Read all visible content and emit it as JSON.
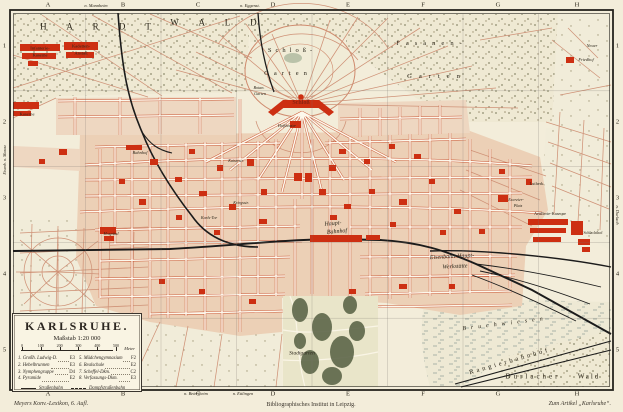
{
  "title": "Karlsruhe — Stadtplan (Meyers Konversations-Lexikon)",
  "frame": {
    "grid_cols": [
      "A",
      "B",
      "C",
      "D",
      "E",
      "F",
      "G",
      "H"
    ],
    "grid_rows": [
      "1",
      "2",
      "3",
      "4",
      "5"
    ]
  },
  "captions": {
    "publisher_left": "Meyers Konv.-Lexikon, 6. Aufl.",
    "publisher_center": "Bibliographisches Institut in Leipzig.",
    "article_right": "Zum Artikel „Karlsruhe“."
  },
  "legend_box": {
    "title": "KARLSRUHE.",
    "scale": "Maßstab 1:20 000",
    "scale_ticks": [
      "0",
      "100",
      "200",
      "300",
      "400",
      "500"
    ],
    "scale_unit": "Meter",
    "items": [
      {
        "label": "1. Großh. Ludwig-D.",
        "ref": "E3"
      },
      {
        "label": "2. Hebelbrunnen",
        "ref": "E3"
      },
      {
        "label": "3. Nymphengruppe",
        "ref": "D4"
      },
      {
        "label": "4. Pyramide",
        "ref": "E2"
      },
      {
        "label": "5. Mädchengymnasium",
        "ref": "F2"
      },
      {
        "label": "6. Realschule",
        "ref": "E2"
      },
      {
        "label": "7. Scheffel-Dkm.",
        "ref": "C2"
      },
      {
        "label": "8. Verfassungs-Dkm.",
        "ref": "E3"
      }
    ],
    "line_keys": [
      {
        "style": "solid",
        "label": "Straßenbahn"
      },
      {
        "style": "dashdot",
        "label": "Dampfstraßenbahn"
      }
    ]
  },
  "colors": {
    "paper": "#f3edda",
    "city_block": "#ecd0b6",
    "landmark_red": "#cd2f12",
    "street_edge": "#c8502e",
    "railway": "#1b1b1b",
    "forest_dot": "#8e8c6e",
    "park_green": "#5d6649"
  },
  "map_labels": [
    {
      "t": "H A R D T",
      "x": 100,
      "y": 27,
      "s": 9,
      "ls": 9
    },
    {
      "t": "W A L D",
      "x": 218,
      "y": 23,
      "s": 9,
      "ls": 9
    },
    {
      "t": "Schloß-",
      "x": 292,
      "y": 51,
      "s": 6.5,
      "ls": 4
    },
    {
      "t": "Garten",
      "x": 288,
      "y": 74,
      "s": 6.5,
      "ls": 5
    },
    {
      "t": "Fasanen-",
      "x": 432,
      "y": 44,
      "s": 6.5,
      "ls": 6
    },
    {
      "t": "Garten",
      "x": 437,
      "y": 77,
      "s": 6.5,
      "ls": 7
    },
    {
      "t": "Schloß",
      "x": 301,
      "y": 103,
      "s": 6,
      "b": 1,
      "c": "#8c2312"
    },
    {
      "t": "Botan.",
      "x": 259,
      "y": 88,
      "s": 4.2,
      "i": 1
    },
    {
      "t": "Garten",
      "x": 260,
      "y": 94,
      "s": 4.2,
      "i": 1
    },
    {
      "t": "Hoftheater",
      "x": 287,
      "y": 126,
      "s": 4.2,
      "i": 1
    },
    {
      "t": "Infanterie-",
      "x": 40,
      "y": 49,
      "s": 4.6
    },
    {
      "t": "Kaserne",
      "x": 40,
      "y": 56,
      "s": 4.6
    },
    {
      "t": "Kadetten-",
      "x": 81,
      "y": 47,
      "s": 4.6
    },
    {
      "t": "Anstalt",
      "x": 81,
      "y": 54,
      "s": 4.6
    },
    {
      "t": "Kaserne",
      "x": 27,
      "y": 115,
      "s": 4.6
    },
    {
      "t": "Bahnhof",
      "x": 140,
      "y": 153,
      "s": 4.4,
      "i": 1
    },
    {
      "t": "Karls-Tor",
      "x": 209,
      "y": 218,
      "s": 4.2,
      "i": 1
    },
    {
      "t": "Hospital",
      "x": 111,
      "y": 234,
      "s": 4.4,
      "i": 1
    },
    {
      "t": "Kaiserstr.",
      "x": 236,
      "y": 161,
      "s": 4,
      "i": 1
    },
    {
      "t": "Kriegsstr.",
      "x": 241,
      "y": 203,
      "s": 4,
      "i": 1
    },
    {
      "t": "Haupt-",
      "x": 333,
      "y": 224,
      "s": 6,
      "i": 1,
      "r": -5
    },
    {
      "t": "Bahnhof",
      "x": 337,
      "y": 232,
      "s": 6,
      "i": 1,
      "r": -5
    },
    {
      "t": "Stadtgarten",
      "x": 302,
      "y": 354,
      "s": 5.5,
      "i": 1
    },
    {
      "t": "Eisenbahn-Haupt-",
      "x": 452,
      "y": 257,
      "s": 6,
      "i": 1,
      "r": -3
    },
    {
      "t": "Werkstätte",
      "x": 455,
      "y": 267,
      "s": 6,
      "i": 1,
      "r": -3
    },
    {
      "t": "Bruchwiesen",
      "x": 505,
      "y": 324,
      "s": 6,
      "ls": 5,
      "r": -7,
      "i": 1
    },
    {
      "t": "Rangierbahnhof",
      "x": 510,
      "y": 362,
      "s": 6.5,
      "ls": 3,
      "r": -16
    },
    {
      "t": "Durlacher",
      "x": 533,
      "y": 377,
      "s": 7,
      "ls": 3
    },
    {
      "t": "Wald",
      "x": 589,
      "y": 377,
      "s": 7,
      "ls": 2
    },
    {
      "t": "Neuer",
      "x": 592,
      "y": 46,
      "s": 4.4,
      "i": 1
    },
    {
      "t": "Friedhof",
      "x": 586,
      "y": 60,
      "s": 4.4,
      "i": 1
    },
    {
      "t": "Lutherk.",
      "x": 537,
      "y": 184,
      "s": 4.4
    },
    {
      "t": "Artillerie-Kaserne",
      "x": 550,
      "y": 214,
      "s": 4.4
    },
    {
      "t": "Schlachthof",
      "x": 593,
      "y": 233,
      "s": 4
    },
    {
      "t": "Exerzier-",
      "x": 516,
      "y": 200,
      "s": 4.2,
      "i": 1
    },
    {
      "t": "Platz",
      "x": 518,
      "y": 206,
      "s": 4.2,
      "i": 1
    },
    {
      "t": "n. Mannheim",
      "x": 96,
      "y": 6,
      "s": 4.4,
      "i": 1
    },
    {
      "t": "n. Eggenst.",
      "x": 250,
      "y": 6,
      "s": 4.4,
      "i": 1
    },
    {
      "t": "n. Beiertheim",
      "x": 196,
      "y": 394,
      "s": 4.4,
      "i": 1
    },
    {
      "t": "n. Ettlingen",
      "x": 243,
      "y": 394,
      "s": 4.4,
      "i": 1
    },
    {
      "t": "n. Durlach",
      "x": 617,
      "y": 215,
      "s": 4.4,
      "i": 1,
      "r": 90
    },
    {
      "t": "Eisenb. n. Maxau",
      "x": 5,
      "y": 160,
      "s": 4.2,
      "i": 1,
      "r": -90
    }
  ]
}
